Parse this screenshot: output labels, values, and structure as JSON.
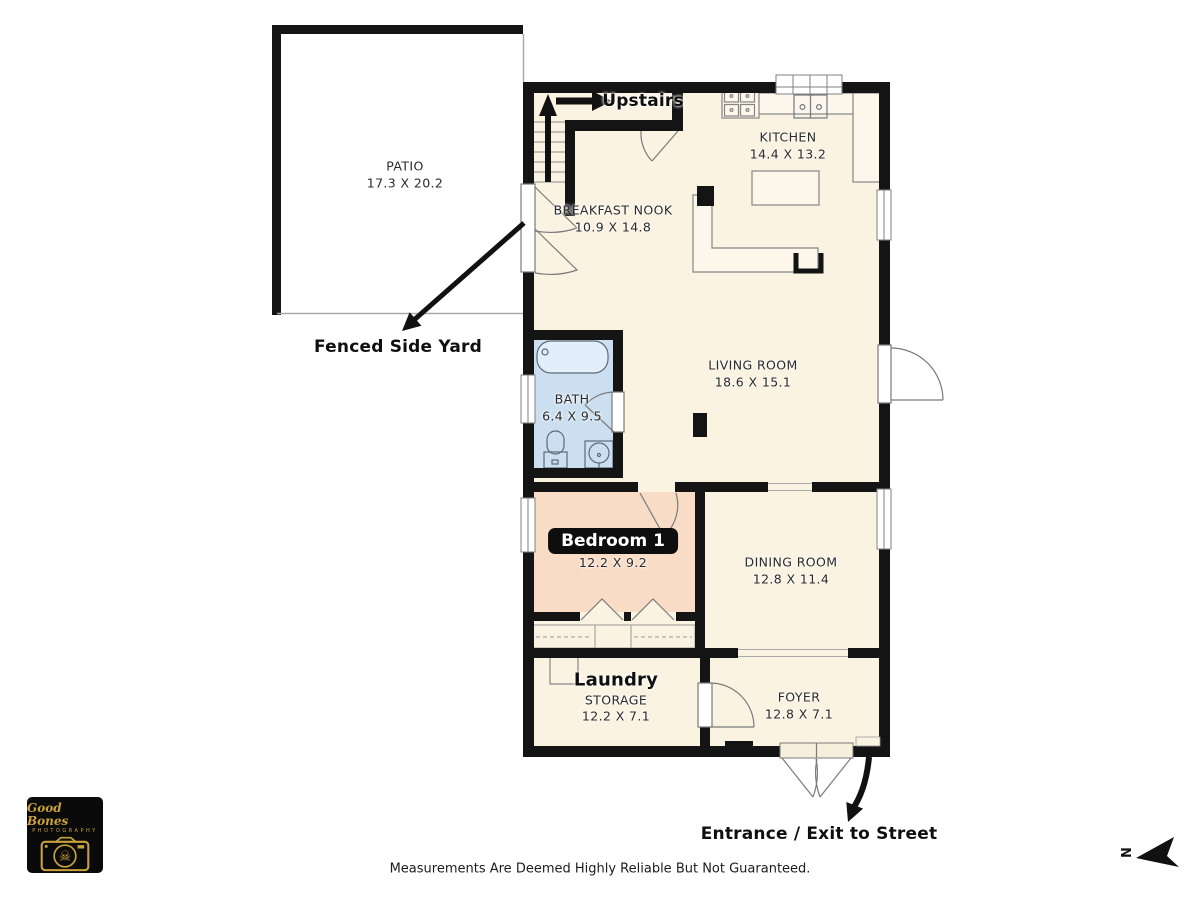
{
  "rooms": {
    "patio": {
      "name": "PATIO",
      "dims": "17.3 X 20.2"
    },
    "kitchen": {
      "name": "KITCHEN",
      "dims": "14.4 X 13.2"
    },
    "breakfast_nook": {
      "name": "BREAKFAST NOOK",
      "dims": "10.9 X 14.8"
    },
    "living_room": {
      "name": "LIVING ROOM",
      "dims": "18.6 X 15.1"
    },
    "bath": {
      "name": "BATH",
      "dims": "6.4 X 9.5"
    },
    "bedroom_1": {
      "name": "Bedroom 1",
      "dims": "12.2 X 9.2"
    },
    "dining_room": {
      "name": "DINING ROOM",
      "dims": "12.8 X 11.4"
    },
    "laundry": {
      "name": "Laundry",
      "subtitle": "STORAGE",
      "dims": "12.2 X 7.1"
    },
    "foyer": {
      "name": "FOYER",
      "dims": "12.8 X 7.1"
    }
  },
  "annotations": {
    "upstairs": "Upstairs",
    "fenced_side_yard": "Fenced Side Yard",
    "entrance_exit": "Entrance / Exit to Street",
    "north_indicator": "N"
  },
  "footer": {
    "disclaimer": "Measurements Are Deemed Highly Reliable But Not Guaranteed."
  },
  "logo": {
    "name": "Good Bones",
    "subtitle": "PHOTOGRAPHY",
    "skull_glyph": "☠"
  },
  "colors": {
    "floor": "#FAF3E2",
    "bath_floor": "#CBDFF0",
    "bedroom_floor": "#F8DCC6",
    "wall": "#141414",
    "logo_gold": "#C9A23B"
  }
}
